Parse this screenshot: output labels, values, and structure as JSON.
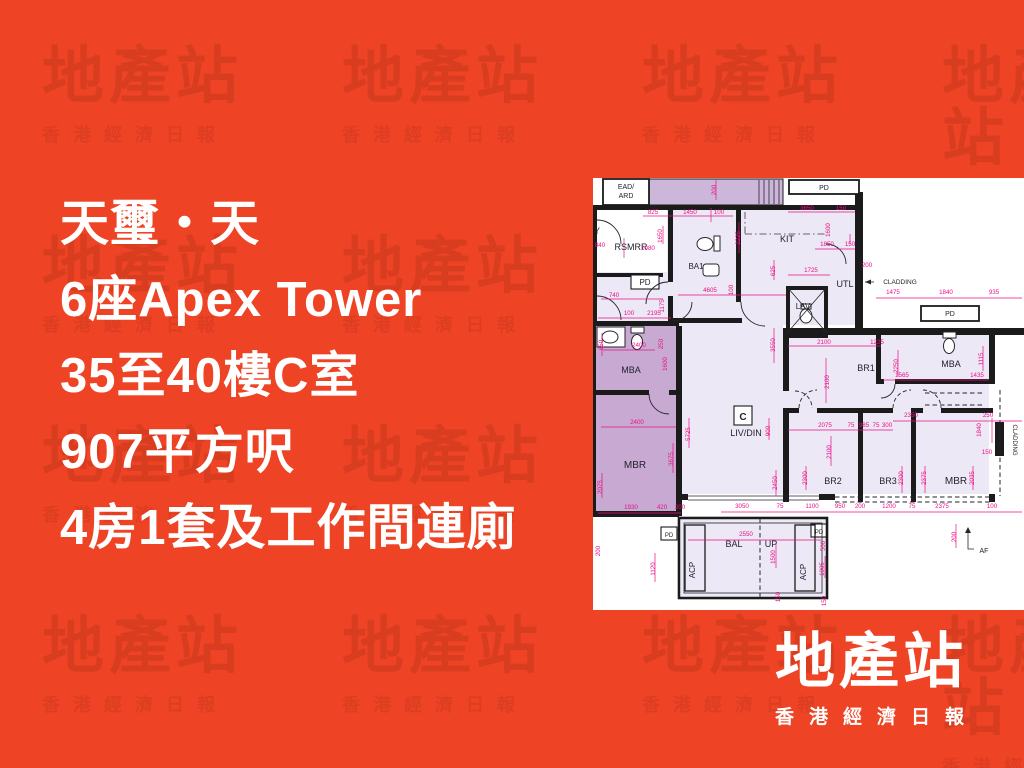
{
  "page": {
    "background": "#ee4324"
  },
  "title": {
    "lines": [
      "天璽・天",
      "6座Apex Tower",
      "35至40樓C室",
      "907平方呎",
      "4房1套及工作間連廁"
    ]
  },
  "watermark": {
    "logo": "地產站",
    "sub": "香港經濟日報"
  },
  "brand": {
    "logo": "地產站",
    "sub": "香港經濟日報"
  },
  "plan": {
    "unit_label": "C",
    "colors": {
      "wall": "#1b1b1b",
      "dim": "#ec1187",
      "room_light": "#ece8f5",
      "room_purple": "#c7a9d2",
      "strip_purple": "#ccb7da",
      "label": "#23232e"
    },
    "rooms": [
      {
        "t": "EAD/",
        "x": 33,
        "y": 11,
        "s": 7
      },
      {
        "t": "ARD",
        "x": 33,
        "y": 20,
        "s": 7
      },
      {
        "t": "PD",
        "x": 231,
        "y": 12,
        "s": 7
      },
      {
        "t": "Y",
        "x": 4,
        "y": 56,
        "s": 9
      },
      {
        "t": "RSMRR",
        "x": 38,
        "y": 72,
        "s": 9
      },
      {
        "t": "PD",
        "x": 52,
        "y": 107,
        "s": 8
      },
      {
        "t": "BA1",
        "x": 103,
        "y": 91,
        "s": 8
      },
      {
        "t": "KIT",
        "x": 194,
        "y": 64,
        "s": 9
      },
      {
        "t": "UTL",
        "x": 252,
        "y": 109,
        "s": 9
      },
      {
        "t": "LAV",
        "x": 210,
        "y": 131,
        "s": 8
      },
      {
        "t": "CLADDING",
        "x": 307,
        "y": 106,
        "s": 6.5
      },
      {
        "t": "MBA",
        "x": 38,
        "y": 195,
        "s": 9
      },
      {
        "t": "MBR",
        "x": 42,
        "y": 290,
        "s": 10
      },
      {
        "t": "BR1",
        "x": 273,
        "y": 193,
        "s": 9
      },
      {
        "t": "MBA",
        "x": 358,
        "y": 189,
        "s": 9
      },
      {
        "t": "PD",
        "x": 357,
        "y": 138,
        "s": 7
      },
      {
        "t": "C",
        "x": 150,
        "y": 242,
        "s": 10,
        "w": 700
      },
      {
        "t": "LIV/DIN",
        "x": 153,
        "y": 258,
        "s": 9
      },
      {
        "t": "BR2",
        "x": 240,
        "y": 306,
        "s": 9
      },
      {
        "t": "BR3",
        "x": 295,
        "y": 306,
        "s": 9
      },
      {
        "t": "MBR",
        "x": 363,
        "y": 306,
        "s": 10
      },
      {
        "t": "BAL",
        "x": 141,
        "y": 369,
        "s": 9
      },
      {
        "t": "UP",
        "x": 178,
        "y": 369,
        "s": 9
      },
      {
        "t": "ACP",
        "x": 102,
        "y": 392,
        "s": 8,
        "r": -90
      },
      {
        "t": "ACP",
        "x": 213,
        "y": 394,
        "s": 8,
        "r": -90
      },
      {
        "t": "PD",
        "x": 76,
        "y": 359,
        "s": 6
      },
      {
        "t": "PD",
        "x": 226,
        "y": 356,
        "s": 6
      },
      {
        "t": "AF",
        "x": 391,
        "y": 375,
        "s": 7
      },
      {
        "t": "CLADDING",
        "x": 420,
        "y": 262,
        "s": 6,
        "r": 90
      }
    ],
    "dims": [
      {
        "t": "825",
        "x": 60,
        "y": 36
      },
      {
        "t": "1450",
        "x": 97,
        "y": 36
      },
      {
        "t": "100",
        "x": 126,
        "y": 36
      },
      {
        "t": "3650",
        "x": 214,
        "y": 32
      },
      {
        "t": "150",
        "x": 248,
        "y": 32
      },
      {
        "t": "200",
        "x": 123,
        "y": 12,
        "r": -90
      },
      {
        "t": "1650",
        "x": 69,
        "y": 58,
        "r": -90
      },
      {
        "t": "840",
        "x": 7,
        "y": 69
      },
      {
        "t": "1080",
        "x": 55,
        "y": 72
      },
      {
        "t": "740",
        "x": 21,
        "y": 119
      },
      {
        "t": "100",
        "x": 36,
        "y": 137
      },
      {
        "t": "2195",
        "x": 61,
        "y": 137
      },
      {
        "t": "1175",
        "x": 71,
        "y": 128,
        "r": -90
      },
      {
        "t": "2225",
        "x": 147,
        "y": 60,
        "r": -90
      },
      {
        "t": "4605",
        "x": 117,
        "y": 114
      },
      {
        "t": "100",
        "x": 140,
        "y": 112,
        "r": -90
      },
      {
        "t": "1850",
        "x": 234,
        "y": 68
      },
      {
        "t": "150",
        "x": 257,
        "y": 68
      },
      {
        "t": "1600",
        "x": 237,
        "y": 52,
        "r": -90
      },
      {
        "t": "1725",
        "x": 218,
        "y": 94
      },
      {
        "t": "625",
        "x": 182,
        "y": 93,
        "r": -90
      },
      {
        "t": "200",
        "x": 274,
        "y": 89
      },
      {
        "t": "1475",
        "x": 300,
        "y": 116
      },
      {
        "t": "1840",
        "x": 353,
        "y": 116
      },
      {
        "t": "935",
        "x": 401,
        "y": 116
      },
      {
        "t": "2100",
        "x": 231,
        "y": 166
      },
      {
        "t": "1225",
        "x": 284,
        "y": 166
      },
      {
        "t": "2100",
        "x": 236,
        "y": 204,
        "r": -90
      },
      {
        "t": "2250",
        "x": 305,
        "y": 188,
        "r": -90
      },
      {
        "t": "1565",
        "x": 309,
        "y": 199
      },
      {
        "t": "1435",
        "x": 384,
        "y": 199
      },
      {
        "t": "1115",
        "x": 390,
        "y": 181,
        "r": -90
      },
      {
        "t": "2350",
        "x": 318,
        "y": 239
      },
      {
        "t": "250",
        "x": 395,
        "y": 239
      },
      {
        "t": "1840",
        "x": 388,
        "y": 252,
        "r": -90
      },
      {
        "t": "150",
        "x": 394,
        "y": 276
      },
      {
        "t": "2075",
        "x": 232,
        "y": 249
      },
      {
        "t": "75",
        "x": 258,
        "y": 249
      },
      {
        "t": "985",
        "x": 271,
        "y": 249
      },
      {
        "t": "75",
        "x": 283,
        "y": 249
      },
      {
        "t": "300",
        "x": 294,
        "y": 249
      },
      {
        "t": "900",
        "x": 177,
        "y": 253,
        "r": -90
      },
      {
        "t": "2450",
        "x": 184,
        "y": 305,
        "r": -90
      },
      {
        "t": "3550",
        "x": 182,
        "y": 167,
        "r": -90
      },
      {
        "t": "5725",
        "x": 97,
        "y": 256,
        "r": -90
      },
      {
        "t": "2100",
        "x": 238,
        "y": 274,
        "r": -90
      },
      {
        "t": "2300",
        "x": 214,
        "y": 300,
        "r": -90
      },
      {
        "t": "2300",
        "x": 310,
        "y": 300,
        "r": -90
      },
      {
        "t": "2375",
        "x": 333,
        "y": 300,
        "r": -90
      },
      {
        "t": "2035",
        "x": 381,
        "y": 300,
        "r": -90
      },
      {
        "t": "2400",
        "x": 46,
        "y": 169
      },
      {
        "t": "250",
        "x": 70,
        "y": 166,
        "r": -90
      },
      {
        "t": "1600",
        "x": 74,
        "y": 186,
        "r": -90
      },
      {
        "t": "650",
        "x": 10,
        "y": 167,
        "r": -90
      },
      {
        "t": "2400",
        "x": 44,
        "y": 246
      },
      {
        "t": "3675",
        "x": 80,
        "y": 281,
        "r": -90
      },
      {
        "t": "2075",
        "x": 9,
        "y": 309,
        "r": -90
      },
      {
        "t": "1930",
        "x": 38,
        "y": 331
      },
      {
        "t": "420",
        "x": 69,
        "y": 331
      },
      {
        "t": "200",
        "x": 87,
        "y": 331
      },
      {
        "t": "3050",
        "x": 149,
        "y": 330
      },
      {
        "t": "75",
        "x": 187,
        "y": 330
      },
      {
        "t": "1100",
        "x": 219,
        "y": 330
      },
      {
        "t": "950",
        "x": 247,
        "y": 330
      },
      {
        "t": "200",
        "x": 267,
        "y": 330
      },
      {
        "t": "1200",
        "x": 296,
        "y": 330
      },
      {
        "t": "75",
        "x": 319,
        "y": 330
      },
      {
        "t": "2375",
        "x": 349,
        "y": 330
      },
      {
        "t": "100",
        "x": 399,
        "y": 330
      },
      {
        "t": "2550",
        "x": 153,
        "y": 358
      },
      {
        "t": "1120",
        "x": 62,
        "y": 391,
        "r": -90
      },
      {
        "t": "200",
        "x": 7,
        "y": 373,
        "r": -90
      },
      {
        "t": "1500",
        "x": 182,
        "y": 379,
        "r": -90
      },
      {
        "t": "500",
        "x": 232,
        "y": 368,
        "r": -90
      },
      {
        "t": "1005",
        "x": 231,
        "y": 391,
        "r": -90
      },
      {
        "t": "150",
        "x": 187,
        "y": 419,
        "r": -90
      },
      {
        "t": "150",
        "x": 233,
        "y": 423,
        "r": -90
      },
      {
        "t": "200",
        "x": 363,
        "y": 359,
        "r": -90
      }
    ]
  }
}
